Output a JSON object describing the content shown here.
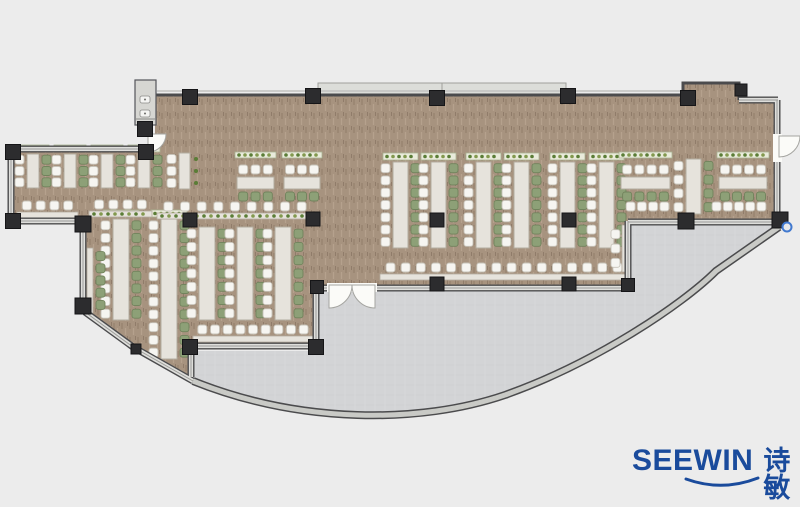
{
  "meta": {
    "description": "Office cafeteria floor plan with rows of shared desks, bar seating, structural columns and a curved glass terrace"
  },
  "brand": {
    "name": "SEEWIN",
    "cjk": "诗敏",
    "color": "#1a4b9c"
  },
  "palette": {
    "background": "#ececec",
    "floor": "#a7937f",
    "terrace": "#d3d4d6",
    "wall": "#4b4b4d",
    "wall_window_fill": "#dededb",
    "column": "#2c2c2e",
    "table": "#e6e3dc",
    "table_border": "#b3ac9f",
    "chair_white": "#f6f5f1",
    "chair_white_border": "#c6c2b8",
    "chair_green": "#8da077",
    "chair_green_border": "#71835c",
    "planter": "#e9ebdb",
    "planter_border": "#a9b292",
    "plant": "#5a7d36",
    "plant_alt": "#82994e",
    "door": "#fbfbf8",
    "marker": "#4179cf"
  },
  "plan": {
    "columns": [
      [
        190,
        97,
        15
      ],
      [
        313,
        96,
        15
      ],
      [
        437,
        98,
        15
      ],
      [
        568,
        96,
        15
      ],
      [
        688,
        98,
        15
      ],
      [
        741,
        90,
        12
      ],
      [
        13,
        152,
        15
      ],
      [
        146,
        152,
        15
      ],
      [
        13,
        221,
        15
      ],
      [
        83,
        224,
        16
      ],
      [
        83,
        306,
        16
      ],
      [
        145,
        129,
        15
      ],
      [
        190,
        220,
        14
      ],
      [
        313,
        219,
        14
      ],
      [
        437,
        220,
        14
      ],
      [
        569,
        220,
        14
      ],
      [
        190,
        347,
        15
      ],
      [
        316,
        347,
        15
      ],
      [
        317,
        287,
        13
      ],
      [
        437,
        284,
        14
      ],
      [
        569,
        284,
        14
      ],
      [
        628,
        285,
        13
      ],
      [
        686,
        221,
        16
      ],
      [
        780,
        220,
        16
      ],
      [
        136,
        349,
        10
      ]
    ],
    "clusters": [
      {
        "type": "v",
        "x": 27,
        "y": 154,
        "w": 12,
        "h": 34,
        "seats": 3,
        "plants": true
      },
      {
        "type": "v",
        "x": 64,
        "y": 154,
        "w": 12,
        "h": 34,
        "seats": 3,
        "plants": true
      },
      {
        "type": "v",
        "x": 101,
        "y": 154,
        "w": 12,
        "h": 34,
        "seats": 3,
        "plants": true
      },
      {
        "type": "v",
        "x": 138,
        "y": 154,
        "w": 12,
        "h": 34,
        "seats": 3,
        "plants": true
      },
      {
        "type": "v",
        "x": 179,
        "y": 153,
        "w": 11,
        "h": 36,
        "seats": 3,
        "right": "plants"
      },
      {
        "type": "h",
        "x": 237,
        "y": 177,
        "w": 37,
        "seats": 3,
        "planter": true
      },
      {
        "type": "h",
        "x": 284,
        "y": 177,
        "w": 36,
        "seats": 3,
        "planter": true
      },
      {
        "type": "v",
        "x": 113,
        "y": 219,
        "w": 16,
        "h": 101,
        "seats": 8,
        "plants": true
      },
      {
        "type": "v",
        "x": 161,
        "y": 219,
        "w": 16,
        "h": 140,
        "seats": 11,
        "plants": true
      },
      {
        "type": "v",
        "x": 199,
        "y": 227,
        "w": 16,
        "h": 93,
        "seats": 7
      },
      {
        "type": "v",
        "x": 237,
        "y": 227,
        "w": 16,
        "h": 93,
        "seats": 7
      },
      {
        "type": "v",
        "x": 275,
        "y": 227,
        "w": 16,
        "h": 93,
        "seats": 7
      },
      {
        "type": "v",
        "x": 393,
        "y": 162,
        "w": 15,
        "h": 86,
        "seats": 7,
        "plants": true
      },
      {
        "type": "v",
        "x": 431,
        "y": 162,
        "w": 15,
        "h": 86,
        "seats": 7,
        "plants": true
      },
      {
        "type": "v",
        "x": 476,
        "y": 162,
        "w": 15,
        "h": 86,
        "seats": 7,
        "plants": true
      },
      {
        "type": "v",
        "x": 514,
        "y": 162,
        "w": 15,
        "h": 86,
        "seats": 7,
        "plants": true
      },
      {
        "type": "v",
        "x": 560,
        "y": 162,
        "w": 15,
        "h": 86,
        "seats": 7,
        "plants": true
      },
      {
        "type": "v",
        "x": 599,
        "y": 162,
        "w": 15,
        "h": 86,
        "seats": 7,
        "plants": true
      },
      {
        "type": "v",
        "x": 686,
        "y": 159,
        "w": 15,
        "h": 55,
        "seats": 4
      },
      {
        "type": "h",
        "x": 621,
        "y": 177,
        "w": 49,
        "seats": 4,
        "planter": true
      },
      {
        "type": "h",
        "x": 719,
        "y": 177,
        "w": 48,
        "seats": 4,
        "planter": true
      }
    ],
    "bars": [
      {
        "dir": "h",
        "x": 20,
        "y": 201,
        "len": 55,
        "chairs": 4,
        "counter": true
      },
      {
        "dir": "h",
        "x": 92,
        "y": 200,
        "len": 57,
        "chairs": 4,
        "counter": true,
        "plants": true
      },
      {
        "dir": "h",
        "x": 160,
        "y": 202,
        "len": 150,
        "chairs": 9,
        "counter": true,
        "plants": true
      },
      {
        "dir": "h",
        "x": 196,
        "y": 325,
        "len": 114,
        "chairs": 9,
        "counter": true
      },
      {
        "dir": "h",
        "x": 383,
        "y": 263,
        "len": 242,
        "chairs": 16,
        "counter": true
      },
      {
        "dir": "v",
        "x": 96,
        "y": 250,
        "len": 61,
        "chairs": 5,
        "color": "green",
        "counter": "before"
      },
      {
        "dir": "v",
        "x": 611,
        "y": 227,
        "len": 43,
        "chairs": 3,
        "counter": "after"
      },
      {
        "dir": "h",
        "x": 625,
        "y": 202,
        "len": 45,
        "chairs": 4
      },
      {
        "dir": "h",
        "x": 711,
        "y": 202,
        "len": 56,
        "chairs": 5
      }
    ]
  }
}
